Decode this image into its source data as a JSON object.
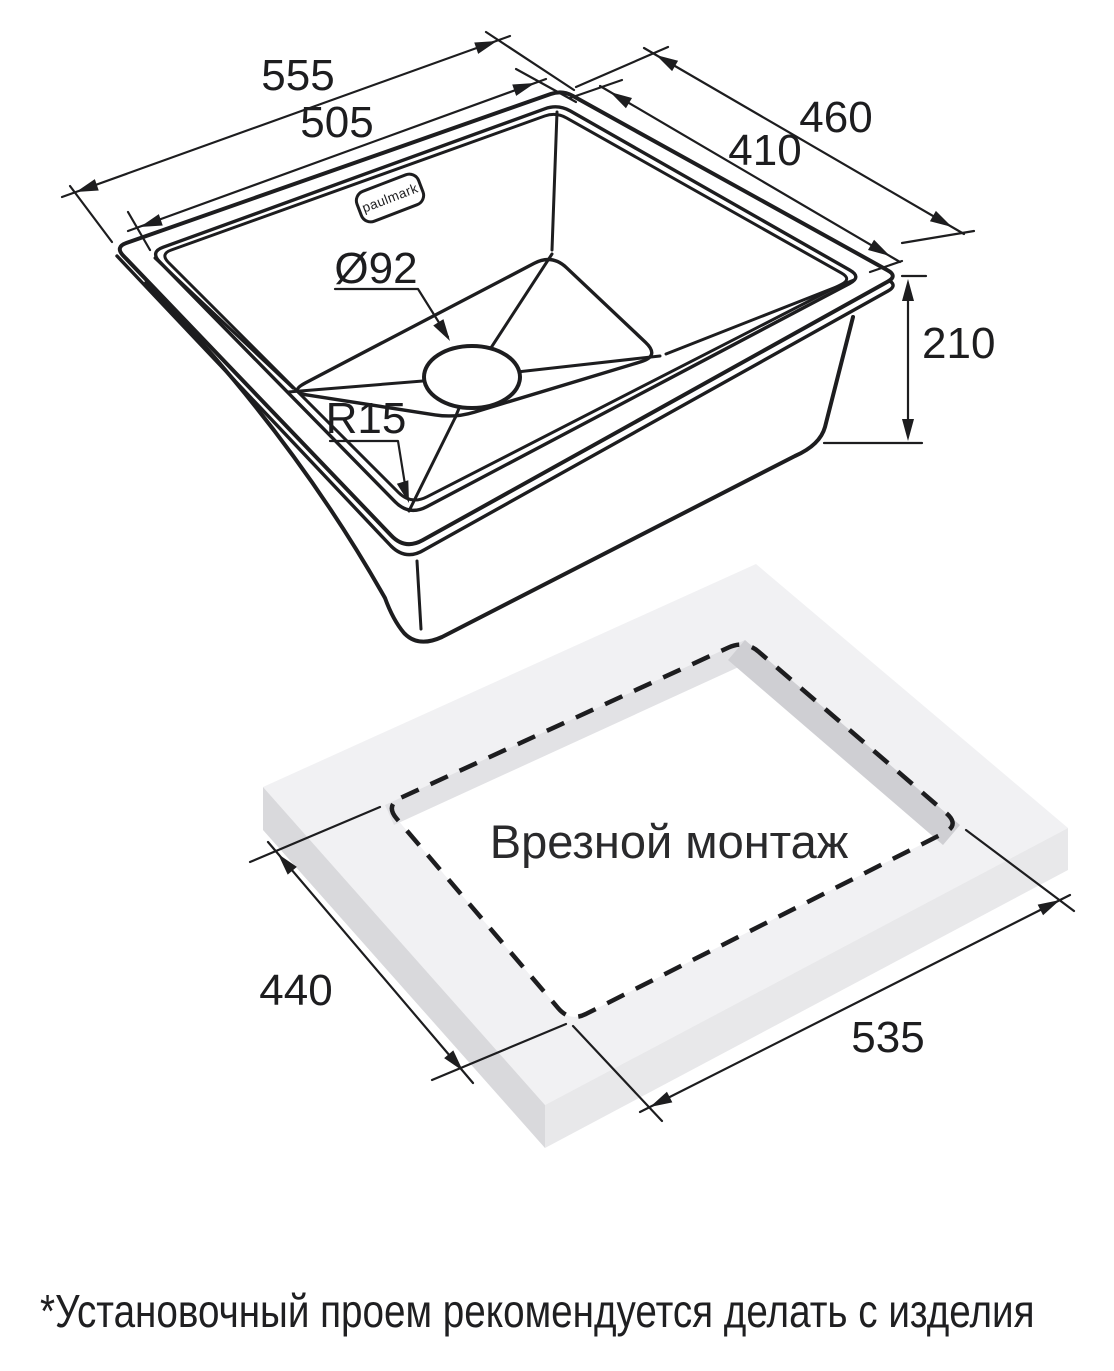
{
  "page": {
    "background": "#ffffff"
  },
  "brand": {
    "logo_text": "paulmark"
  },
  "sink_view": {
    "dim_top_width_outer": "555",
    "dim_top_width_inner": "505",
    "dim_top_depth_outer": "460",
    "dim_top_depth_inner": "410",
    "dim_drain_diameter": "Ø92",
    "dim_bowl_corner_radius": "R15",
    "dim_height": "210"
  },
  "cutout_view": {
    "title": "Врезной монтаж",
    "dim_cutout_width": "440",
    "dim_cutout_length": "535"
  },
  "footnote": "*Установочный проем рекомендуется делать с изделия",
  "colors": {
    "line": "#1d1d1f",
    "countertop_top": "#f1f1f3",
    "countertop_side_left": "#d9d9dc",
    "countertop_side_right": "#e8e8ea",
    "cutout_wall_upper": "#e2e2e5",
    "cutout_wall_right": "#cfcfd3"
  }
}
